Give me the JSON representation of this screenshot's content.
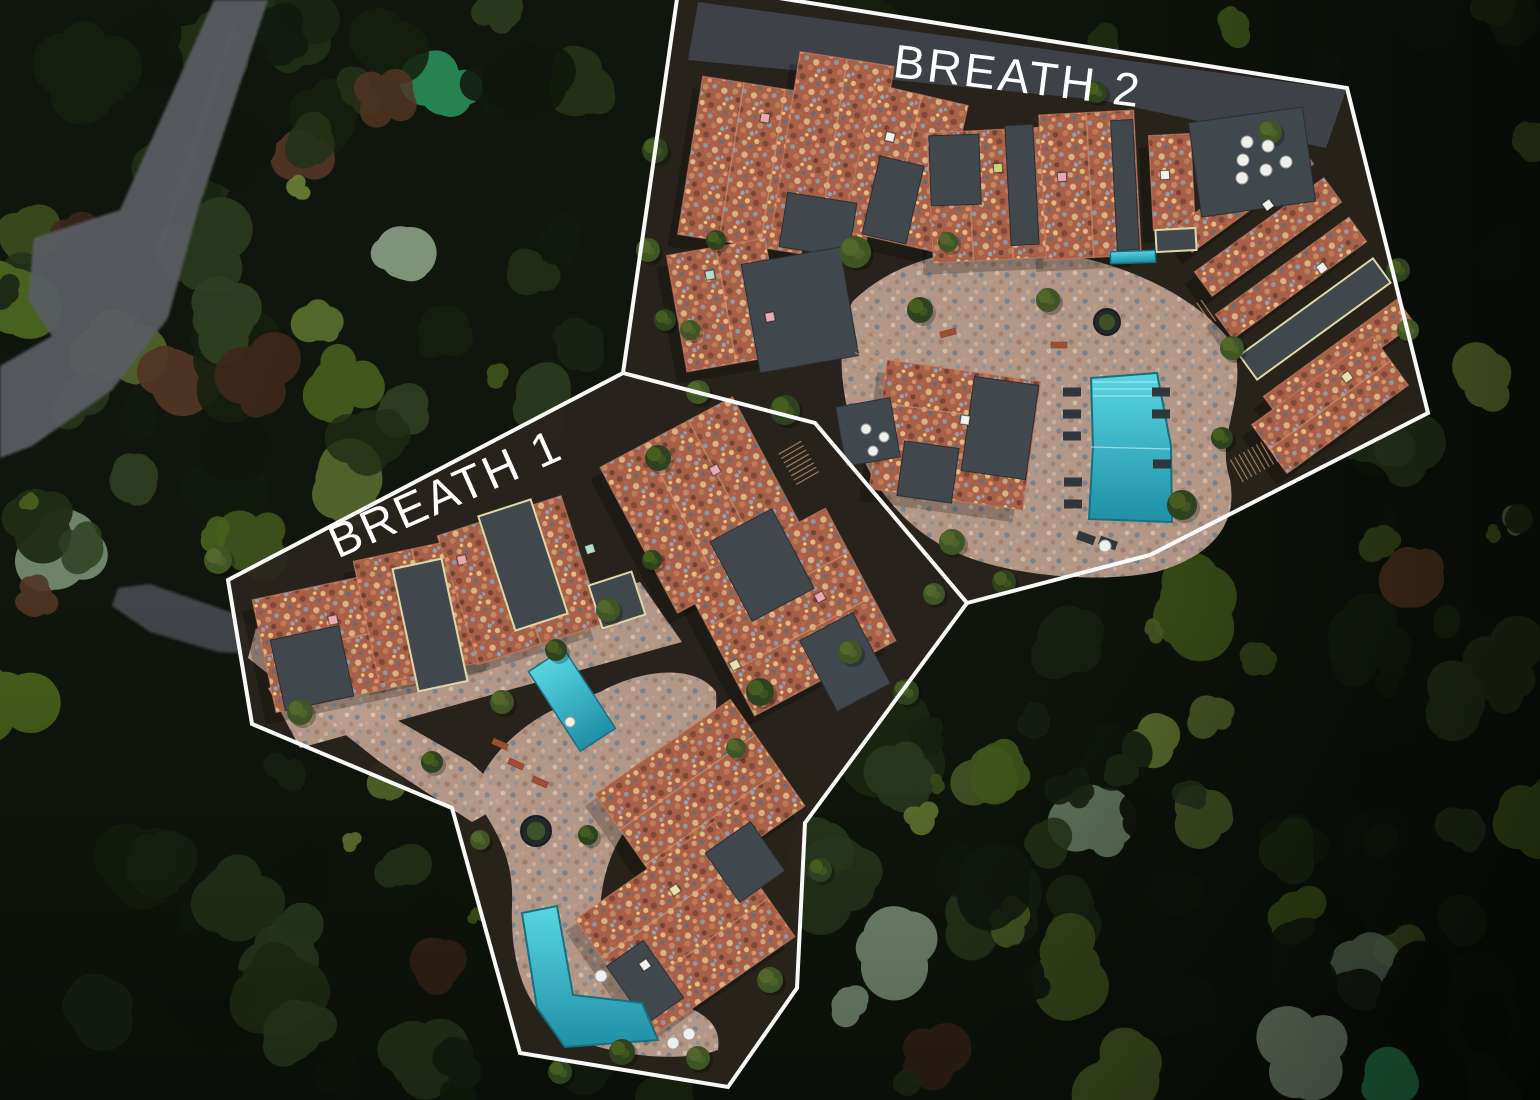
{
  "page": {
    "title": "Aerial masterplan — BREATH residential phases",
    "type": "aerial-site-plan"
  },
  "scene": {
    "width": 1540,
    "height": 1100,
    "colors": {
      "forest_base": "#10160d",
      "road": "#585c61",
      "road_entry": "#4a4e53",
      "asphalt": "#3f444b",
      "zone_ground": "#2a241d",
      "zone_wall": "#7c4a38",
      "flat_roof": "#40474d",
      "flat_roof_edge": "#2a2f34",
      "trim_cream": "#ded7a6",
      "roof_edge": "#c97f63",
      "ridge": "#d7a07b",
      "stone_base": "#b99c8c",
      "terra_base": "#a86049",
      "pool_stroke": "#16707f",
      "pool_step": "#bfeef2",
      "lounger": "#30363b",
      "table_white": "#f0efea",
      "bench": "#9e4f33",
      "stair": "#c49b76",
      "outline": "#ffffff",
      "label": "#ffffff"
    },
    "forest": {
      "seed": 12,
      "clumps": 280,
      "accents": 26,
      "palettes": {
        "dark": [
          "#121a10",
          "#16200f",
          "#1a2415",
          "#0f150c"
        ],
        "mid": [
          "#243217",
          "#2b3a1e",
          "#202c15",
          "#2f3f22"
        ],
        "light": [
          "#49611e",
          "#55682c",
          "#6d8136",
          "#41541e"
        ],
        "sage": [
          "#7d9478",
          "#93a88e",
          "#6c8468"
        ],
        "emerald": [
          "#2d9d62",
          "#35a86b"
        ],
        "rust": [
          "#3d281c",
          "#523524",
          "#61402a"
        ]
      }
    },
    "roads": [
      {
        "name": "mountain-road",
        "d": "M214,0 L268,0 L198,210 L168,318 L112,390 L32,446 L0,458 L0,366 L52,336 L28,300 L34,238 L120,210 L156,130 Z",
        "fill": "#585c61",
        "opacity": 0.95
      },
      {
        "name": "entry-road",
        "d": "M118,588 L150,584 L230,612 L262,630 L258,654 L218,652 L150,632 L112,606 Z",
        "fill": "#4a4e53",
        "opacity": 0.85
      }
    ],
    "zones": [
      {
        "id": "breath-1",
        "label": "BREATH 1",
        "label_x": 452,
        "label_y": 508,
        "label_rot": -24,
        "font_size": 47,
        "plate": [
          [
            623,
            373
          ],
          [
            228,
            580
          ],
          [
            252,
            724
          ],
          [
            452,
            808
          ],
          [
            520,
            1053
          ],
          [
            728,
            1087
          ],
          [
            797,
            988
          ],
          [
            805,
            823
          ],
          [
            967,
            603
          ],
          [
            815,
            423
          ]
        ],
        "outline_segments": [
          [
            [
              623,
              373
            ],
            [
              228,
              580
            ],
            [
              252,
              724
            ],
            [
              452,
              808
            ],
            [
              520,
              1053
            ],
            [
              728,
              1087
            ],
            [
              797,
              988
            ],
            [
              805,
              823
            ],
            [
              967,
              603
            ],
            [
              815,
              423
            ],
            [
              623,
              373
            ]
          ]
        ]
      },
      {
        "id": "breath-2",
        "label": "BREATH 2",
        "label_x": 1016,
        "label_y": 92,
        "label_rot": 7,
        "font_size": 47,
        "plate": [
          [
            678,
            -8
          ],
          [
            623,
            373
          ],
          [
            815,
            423
          ],
          [
            967,
            603
          ],
          [
            1150,
            555
          ],
          [
            1428,
            413
          ],
          [
            1347,
            88
          ],
          [
            741,
            -8
          ]
        ],
        "outline_segments": [
          [
            [
              678,
              -8
            ],
            [
              623,
              373
            ]
          ],
          [
            [
              967,
              603
            ],
            [
              1150,
              555
            ],
            [
              1428,
              413
            ],
            [
              1347,
              88
            ],
            [
              741,
              -8
            ]
          ]
        ]
      }
    ],
    "asphalt_strips": [
      "M698,2 L1346,90 L1326,148 L1100,100 L688,60 Z"
    ],
    "plazas": [
      "M852,302 C898,256 978,240 1052,252 C1132,264 1202,300 1234,346 C1247,396 1218,432 1228,472 C1242,522 1213,556 1156,572 C1096,584 1006,576 953,551 C903,528 868,482 853,432 C840,386 836,342 852,302 Z",
      "M600,692 C652,664 700,668 716,692 C720,732 692,762 662,792 C622,822 602,862 600,912 C600,962 622,986 662,998 C702,1010 722,1022 718,1050 C678,1064 600,1056 560,1030 C524,1008 510,960 512,905 C514,856 496,832 478,802 C470,772 520,722 562,706 Z",
      "M268,688 L640,582 L682,642 L300,748 Z",
      "M256,628 L362,700 L470,762 L512,800 L472,822 L380,762 L248,658 Z"
    ],
    "buildings": [
      [
        752,
        165,
        125,
        160,
        9,
        2
      ],
      [
        833,
        148,
        95,
        180,
        9,
        1
      ],
      [
        905,
        168,
        95,
        150,
        13,
        1
      ],
      [
        990,
        195,
        120,
        130,
        -3,
        2
      ],
      [
        1090,
        185,
        95,
        145,
        -3,
        1
      ],
      [
        1172,
        182,
        42,
        95,
        -3,
        0
      ],
      [
        726,
        305,
        100,
        118,
        -10,
        1
      ],
      [
        955,
        435,
        155,
        130,
        8,
        2
      ],
      [
        1244,
        196,
        150,
        30,
        -36,
        0
      ],
      [
        1268,
        237,
        160,
        30,
        -36,
        0
      ],
      [
        1291,
        278,
        165,
        30,
        -36,
        0
      ],
      [
        1339,
        360,
        165,
        30,
        -36,
        0
      ],
      [
        1330,
        405,
        150,
        60,
        -36,
        1
      ],
      [
        340,
        640,
        155,
        115,
        -12,
        1
      ],
      [
        425,
        610,
        120,
        125,
        -12,
        1
      ],
      [
        520,
        580,
        130,
        135,
        -18,
        1
      ],
      [
        705,
        505,
        150,
        165,
        -28,
        2
      ],
      [
        790,
        612,
        160,
        150,
        -28,
        2
      ],
      [
        700,
        800,
        165,
        130,
        -35,
        2
      ],
      [
        685,
        928,
        170,
        140,
        -35,
        2
      ]
    ],
    "dark_roofs": [
      [
        818,
        225,
        70,
        55,
        9,
        0
      ],
      [
        893,
        200,
        45,
        80,
        13,
        0
      ],
      [
        955,
        170,
        50,
        70,
        -2,
        0
      ],
      [
        1022,
        185,
        28,
        120,
        -3,
        0
      ],
      [
        1125,
        185,
        22,
        130,
        -3,
        0
      ],
      [
        1176,
        240,
        40,
        22,
        -3,
        1
      ],
      [
        800,
        310,
        100,
        110,
        -10,
        0
      ],
      [
        1000,
        428,
        65,
        95,
        8,
        0
      ],
      [
        928,
        472,
        55,
        55,
        8,
        0
      ],
      [
        1315,
        319,
        165,
        30,
        -36,
        1
      ],
      [
        1252,
        162,
        115,
        95,
        -8,
        0
      ],
      [
        868,
        432,
        55,
        60,
        -10,
        0
      ],
      [
        312,
        668,
        70,
        72,
        -12,
        0
      ],
      [
        430,
        625,
        50,
        125,
        -12,
        1
      ],
      [
        523,
        565,
        55,
        120,
        -18,
        1
      ],
      [
        617,
        600,
        45,
        45,
        -18,
        1
      ],
      [
        762,
        565,
        70,
        90,
        -28,
        0
      ],
      [
        845,
        662,
        60,
        80,
        -28,
        0
      ],
      [
        745,
        862,
        55,
        60,
        -35,
        0
      ],
      [
        645,
        982,
        45,
        70,
        -35,
        0
      ]
    ],
    "pools": {
      "polys": [
        [
          [
            1091,
            378
          ],
          [
            1157,
            373
          ],
          [
            1171,
            446
          ],
          [
            1172,
            522
          ],
          [
            1089,
            519
          ],
          [
            1093,
            447
          ]
        ],
        [
          [
            522,
            913
          ],
          [
            557,
            906
          ],
          [
            573,
            995
          ],
          [
            642,
            1003
          ],
          [
            658,
            1040
          ],
          [
            565,
            1047
          ],
          [
            537,
            1008
          ]
        ]
      ],
      "rects": [
        [
          572,
          700,
          42,
          95,
          -33
        ],
        [
          1133,
          257,
          45,
          12,
          -2
        ]
      ],
      "lines": [
        [
          1093,
          382,
          1157,
          382
        ],
        [
          1093,
          389,
          1157,
          389
        ],
        [
          1093,
          396,
          1157,
          396
        ],
        [
          1091,
          447,
          1170,
          449
        ]
      ]
    },
    "details": {
      "loungers": [
        [
          1072,
          392,
          0
        ],
        [
          1072,
          414,
          0
        ],
        [
          1072,
          436,
          0
        ],
        [
          1073,
          482,
          0
        ],
        [
          1073,
          504,
          0
        ],
        [
          1161,
          392,
          0
        ],
        [
          1161,
          414,
          0
        ],
        [
          1162,
          464,
          0
        ],
        [
          1086,
          538,
          20
        ],
        [
          1108,
          543,
          20
        ]
      ],
      "tables": [
        [
          1247,
          142,
          6
        ],
        [
          1243,
          160,
          6
        ],
        [
          1242,
          178,
          6
        ],
        [
          1268,
          146,
          6
        ],
        [
          1266,
          170,
          6
        ],
        [
          1286,
          162,
          6
        ],
        [
          866,
          429,
          5
        ],
        [
          884,
          437,
          5
        ],
        [
          873,
          451,
          5
        ],
        [
          601,
          976,
          6
        ],
        [
          673,
          1043,
          6
        ],
        [
          689,
          1034,
          6
        ],
        [
          1105,
          546,
          6
        ],
        [
          570,
          722,
          5
        ]
      ],
      "planters": [
        [
          536,
          831,
          15
        ],
        [
          1107,
          322,
          13
        ]
      ],
      "benches": [
        [
          516,
          764,
          24
        ],
        [
          540,
          782,
          24
        ],
        [
          500,
          744,
          24
        ],
        [
          948,
          333,
          -15
        ],
        [
          1059,
          345,
          0
        ]
      ],
      "stairs": [
        [
          870,
          352,
          28,
          9
        ],
        [
          800,
          465,
          -30,
          8
        ],
        [
          1192,
          322,
          55,
          8
        ],
        [
          1252,
          462,
          60,
          9
        ]
      ],
      "chimney_colors": [
        "#e9aab2",
        "#f1f1ee",
        "#b7dcca",
        "#e9e0ad",
        "#cfd27e"
      ],
      "chimneys": [
        [
          765,
          118,
          0,
          9
        ],
        [
          890,
          137,
          1,
          13
        ],
        [
          710,
          275,
          2,
          -10
        ],
        [
          770,
          317,
          0,
          -10
        ],
        [
          998,
          168,
          4,
          -3
        ],
        [
          1062,
          177,
          0,
          -3
        ],
        [
          1165,
          175,
          1,
          -3
        ],
        [
          1268,
          205,
          1,
          -36
        ],
        [
          1322,
          268,
          1,
          -36
        ],
        [
          1347,
          377,
          3,
          -36
        ],
        [
          965,
          420,
          1,
          8
        ],
        [
          333,
          620,
          0,
          -12
        ],
        [
          462,
          560,
          0,
          -12
        ],
        [
          590,
          549,
          2,
          -18
        ],
        [
          715,
          470,
          0,
          -28
        ],
        [
          820,
          597,
          0,
          -28
        ],
        [
          735,
          665,
          3,
          -28
        ],
        [
          675,
          890,
          3,
          -35
        ],
        [
          645,
          965,
          1,
          -35
        ]
      ],
      "site_trees": [
        [
          855,
          252,
          16,
          0
        ],
        [
          920,
          310,
          13,
          1
        ],
        [
          1048,
          300,
          12,
          0
        ],
        [
          785,
          410,
          15,
          1
        ],
        [
          698,
          392,
          12,
          0
        ],
        [
          658,
          458,
          13,
          1
        ],
        [
          608,
          610,
          12,
          0
        ],
        [
          556,
          650,
          11,
          1
        ],
        [
          502,
          702,
          12,
          0
        ],
        [
          760,
          692,
          14,
          1
        ],
        [
          850,
          652,
          12,
          0
        ],
        [
          906,
          692,
          13,
          1
        ],
        [
          952,
          542,
          13,
          0
        ],
        [
          1182,
          505,
          15,
          1
        ],
        [
          1232,
          348,
          12,
          0
        ],
        [
          1004,
          582,
          12,
          1
        ],
        [
          934,
          594,
          11,
          0
        ],
        [
          622,
          1052,
          13,
          1
        ],
        [
          698,
          1058,
          12,
          0
        ],
        [
          560,
          1072,
          12,
          1
        ],
        [
          300,
          712,
          13,
          0
        ],
        [
          432,
          762,
          11,
          1
        ],
        [
          218,
          560,
          14,
          0
        ],
        [
          652,
          560,
          10,
          1
        ],
        [
          736,
          748,
          10,
          0
        ],
        [
          588,
          835,
          10,
          1
        ],
        [
          480,
          840,
          10,
          0
        ],
        [
          1222,
          438,
          11,
          1
        ],
        [
          1270,
          132,
          12,
          0
        ],
        [
          1096,
          92,
          11,
          1
        ],
        [
          948,
          242,
          10,
          0
        ],
        [
          716,
          240,
          10,
          1
        ],
        [
          690,
          330,
          10,
          0
        ],
        [
          1398,
          270,
          12,
          1
        ],
        [
          1408,
          330,
          11,
          0
        ],
        [
          655,
          150,
          13,
          1
        ],
        [
          648,
          250,
          12,
          0
        ],
        [
          665,
          320,
          11,
          1
        ],
        [
          770,
          980,
          13,
          0
        ],
        [
          820,
          870,
          12,
          1
        ]
      ]
    }
  }
}
